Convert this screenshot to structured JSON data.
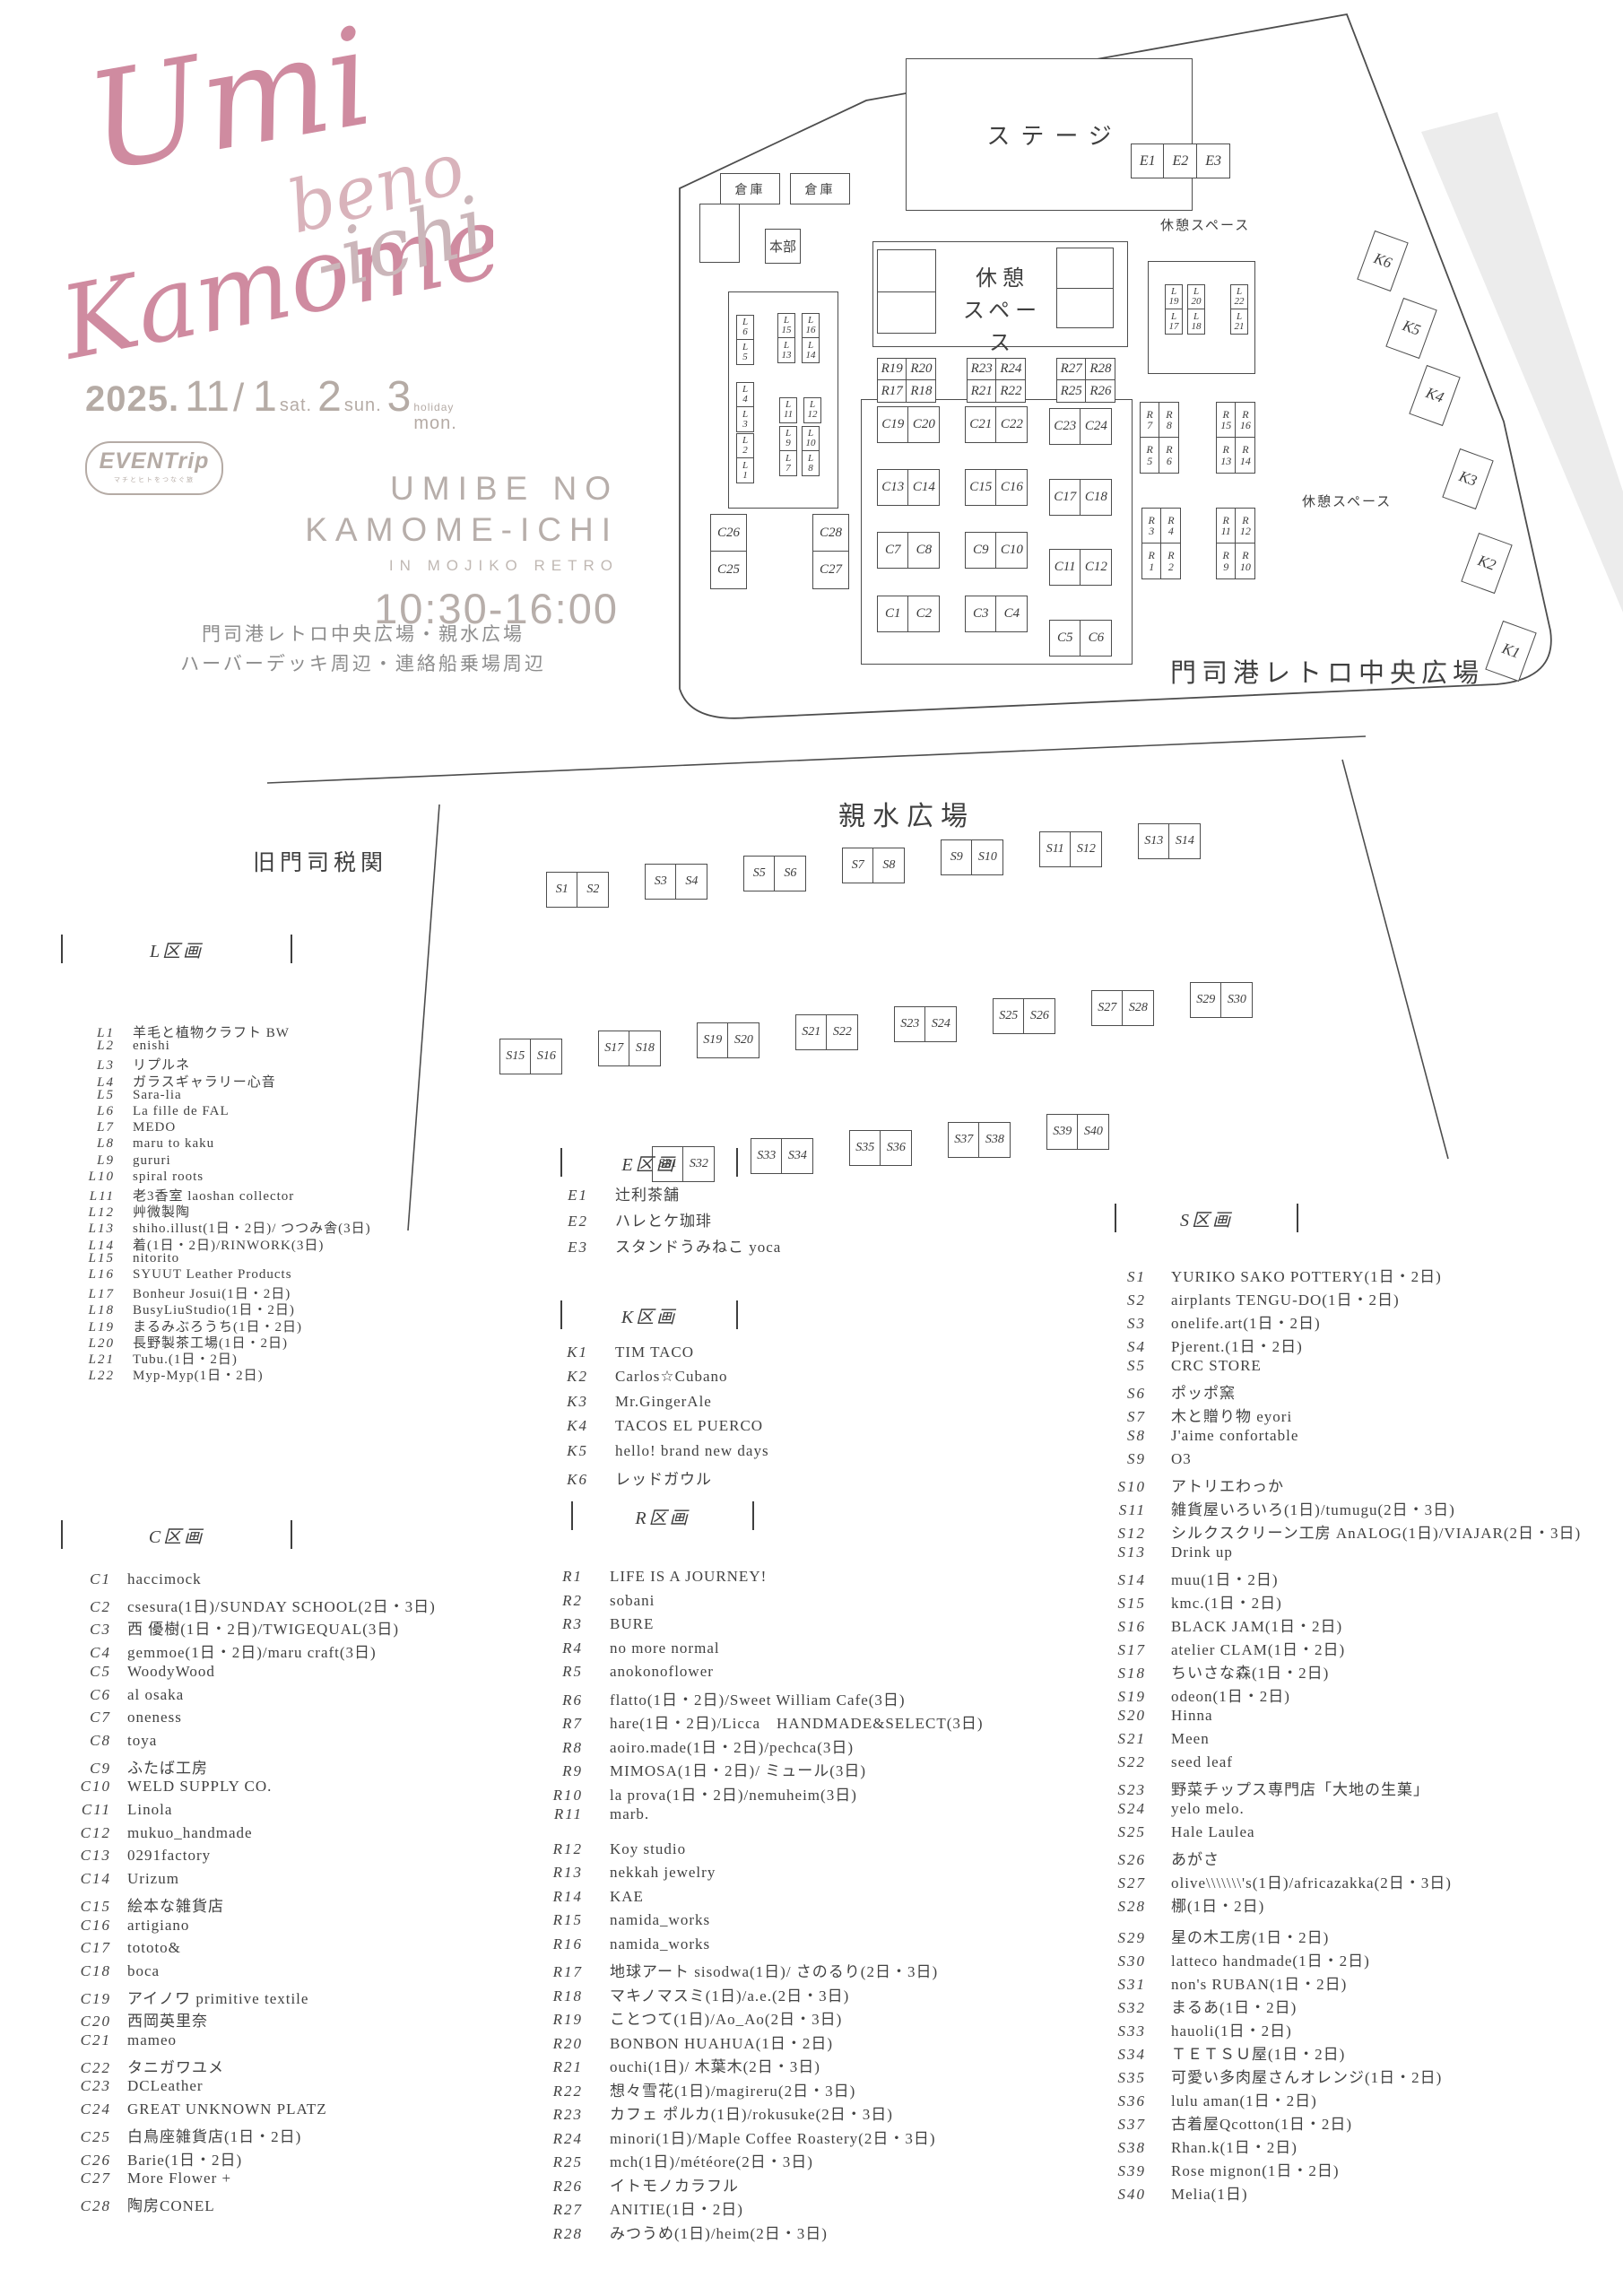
{
  "logo": {
    "word1": "Umi",
    "word2": "beno",
    "word3": "Kamome",
    "word4": "-ichi"
  },
  "event": {
    "year": "2025.",
    "month": "11",
    "slash": "/",
    "day1": "1",
    "day1_suffix": "sat.",
    "day2": "2",
    "day2_suffix": "sun.",
    "day3": "3",
    "day3_suffix": "mon.",
    "day3_note": "holiday",
    "organizer": "EVENTrip",
    "organizer_sub": "マチとヒトをつなぐ旅",
    "title_line1": "UMIBE NO",
    "title_line2": "KAMOME-ICHI",
    "subtitle": "IN MOJIKO RETRO",
    "time": "10:30-16:00",
    "venue_line1": "門司港レトロ中央広場・親水広場",
    "venue_line2": "ハーバーデッキ周辺・連絡船乗場周辺"
  },
  "map_a": {
    "stage": "ステージ",
    "warehouse1": "倉庫",
    "warehouse2": "倉庫",
    "hq": "本部",
    "rest_center": "休憩\nスペース",
    "rest_top_right": "休憩スペース",
    "rest_right": "休憩スペース",
    "area_label": "門司港レトロ中央広場",
    "l_stacks": [
      [
        "L\n6",
        "L\n5"
      ],
      [
        "L\n15",
        "L\n13"
      ],
      [
        "L\n16",
        "L\n14"
      ],
      [
        "L\n4",
        "L\n3"
      ],
      [
        "L\n11"
      ],
      [
        "L\n12"
      ],
      [
        "L\n2",
        "L\n1"
      ],
      [
        "L\n9",
        "L\n7"
      ],
      [
        "L\n10",
        "L\n8"
      ],
      [
        "L\n19",
        "L\n17"
      ],
      [
        "L\n20",
        "L\n18"
      ],
      [
        "L\n22",
        "L\n21"
      ]
    ],
    "c_vstacks": [
      [
        "C26",
        "C25"
      ],
      [
        "C28",
        "C27"
      ]
    ],
    "c_pairs": [
      [
        "C19",
        "C20"
      ],
      [
        "C21",
        "C22"
      ],
      [
        "C23",
        "C24"
      ],
      [
        "C13",
        "C14"
      ],
      [
        "C15",
        "C16"
      ],
      [
        "C17",
        "C18"
      ],
      [
        "C7",
        "C8"
      ],
      [
        "C9",
        "C10"
      ],
      [
        "C11",
        "C12"
      ],
      [
        "C1",
        "C2"
      ],
      [
        "C3",
        "C4"
      ],
      [
        "C5",
        "C6"
      ]
    ],
    "r_blocks": [
      [
        "R19",
        "R20",
        "R17",
        "R18"
      ],
      [
        "R23",
        "R24",
        "R21",
        "R22"
      ],
      [
        "R27",
        "R28",
        "R25",
        "R26"
      ]
    ],
    "r_side_blocks": [
      [
        "R\n7",
        "R\n8",
        "R\n5",
        "R\n6"
      ],
      [
        "R\n15",
        "R\n16",
        "R\n13",
        "R\n14"
      ],
      [
        "R\n3",
        "R\n4",
        "R\n1",
        "R\n2"
      ],
      [
        "R\n11",
        "R\n12",
        "R\n9",
        "R\n10"
      ]
    ],
    "e_row": [
      "E1",
      "E2",
      "E3"
    ],
    "k_boxes": [
      "K6",
      "K5",
      "K4",
      "K3",
      "K2",
      "K1"
    ]
  },
  "map_b": {
    "title": "親水広場",
    "building": "旧門司税関",
    "s_booths": [
      "S1",
      "S2",
      "S3",
      "S4",
      "S5",
      "S6",
      "S7",
      "S8",
      "S9",
      "S10",
      "S11",
      "S12",
      "S13",
      "S14",
      "S15",
      "S16",
      "S17",
      "S18",
      "S19",
      "S20",
      "S21",
      "S22",
      "S23",
      "S24",
      "S25",
      "S26",
      "S27",
      "S28",
      "S29",
      "S30",
      "S31",
      "S32",
      "S33",
      "S34",
      "S35",
      "S36",
      "S37",
      "S38",
      "S39",
      "S40"
    ]
  },
  "lists": {
    "l": {
      "title": "L区画",
      "items": [
        {
          "no": "L1",
          "name": "羊毛と植物クラフト BW"
        },
        {
          "no": "L2",
          "name": "enishi"
        },
        {
          "no": "L3",
          "name": "リプルネ"
        },
        {
          "no": "L4",
          "name": "ガラスギャラリー心音"
        },
        {
          "no": "L5",
          "name": "Sara-lia"
        },
        {
          "no": "L6",
          "name": "La fille de FAL"
        },
        {
          "no": "L7",
          "name": "MEDO"
        },
        {
          "no": "L8",
          "name": "maru to kaku"
        },
        {
          "no": "L9",
          "name": "gururi"
        },
        {
          "no": "L10",
          "name": "spiral roots"
        },
        {
          "no": "L11",
          "name": "老3香室 laoshan collector"
        },
        {
          "no": "L12",
          "name": "艸微製陶"
        },
        {
          "no": "L13",
          "name": "shiho.illust(1日・2日)/ つつみ舎(3日)"
        },
        {
          "no": "L14",
          "name": "着(1日・2日)/RINWORK(3日)"
        },
        {
          "no": "L15",
          "name": "nitorito"
        },
        {
          "no": "L16",
          "name": "SYUUT Leather Products"
        },
        {
          "no": "L17",
          "name": "Bonheur Josui(1日・2日)"
        },
        {
          "no": "L18",
          "name": "BusyLiuStudio(1日・2日)"
        },
        {
          "no": "L19",
          "name": "まるみぶろうち(1日・2日)"
        },
        {
          "no": "L20",
          "name": "長野製茶工場(1日・2日)"
        },
        {
          "no": "L21",
          "name": "Tubu.(1日・2日)"
        },
        {
          "no": "L22",
          "name": "Myp-Myp(1日・2日)"
        }
      ]
    },
    "c": {
      "title": "C区画",
      "items": [
        {
          "no": "C1",
          "name": "haccimock"
        },
        {
          "no": "C2",
          "name": "csesura(1日)/SUNDAY SCHOOL(2日・3日)"
        },
        {
          "no": "C3",
          "name": "西 優樹(1日・2日)/TWIGEQUAL(3日)"
        },
        {
          "no": "C4",
          "name": "gemmoe(1日・2日)/maru craft(3日)"
        },
        {
          "no": "C5",
          "name": "WoodyWood"
        },
        {
          "no": "C6",
          "name": "al osaka"
        },
        {
          "no": "C7",
          "name": "oneness"
        },
        {
          "no": "C8",
          "name": "toya"
        },
        {
          "no": "C9",
          "name": "ふたば工房"
        },
        {
          "no": "C10",
          "name": "WELD SUPPLY CO."
        },
        {
          "no": "C11",
          "name": "Linola"
        },
        {
          "no": "C12",
          "name": "mukuo_handmade"
        },
        {
          "no": "C13",
          "name": "0291factory"
        },
        {
          "no": "C14",
          "name": "Urizum"
        },
        {
          "no": "C15",
          "name": "絵本な雑貨店"
        },
        {
          "no": "C16",
          "name": "artigiano"
        },
        {
          "no": "C17",
          "name": "tototo&"
        },
        {
          "no": "C18",
          "name": "boca"
        },
        {
          "no": "C19",
          "name": "アイノワ primitive textile"
        },
        {
          "no": "C20",
          "name": "西岡英里奈"
        },
        {
          "no": "C21",
          "name": "mameo"
        },
        {
          "no": "C22",
          "name": "タニガワユメ"
        },
        {
          "no": "C23",
          "name": "DCLeather"
        },
        {
          "no": "C24",
          "name": "GREAT UNKNOWN PLATZ"
        },
        {
          "no": "C25",
          "name": "白鳥座雑貨店(1日・2日)"
        },
        {
          "no": "C26",
          "name": "Barie(1日・2日)"
        },
        {
          "no": "C27",
          "name": "More Flower +"
        },
        {
          "no": "C28",
          "name": "陶房CONEL"
        }
      ]
    },
    "e": {
      "title": "E区画",
      "items": [
        {
          "no": "E1",
          "name": "辻利茶舗"
        },
        {
          "no": "E2",
          "name": "ハレとケ珈琲"
        },
        {
          "no": "E3",
          "name": "スタンドうみねこ yoca"
        }
      ]
    },
    "k": {
      "title": "K区画",
      "items": [
        {
          "no": "K1",
          "name": "TIM TACO"
        },
        {
          "no": "K2",
          "name": "Carlos☆Cubano"
        },
        {
          "no": "K3",
          "name": "Mr.GingerAle"
        },
        {
          "no": "K4",
          "name": "TACOS EL PUERCO"
        },
        {
          "no": "K5",
          "name": "hello! brand new days"
        },
        {
          "no": "K6",
          "name": "レッドガウル"
        }
      ]
    },
    "r": {
      "title": "R区画",
      "items": [
        {
          "no": "R1",
          "name": "LIFE IS A JOURNEY!"
        },
        {
          "no": "R2",
          "name": "sobani"
        },
        {
          "no": "R3",
          "name": "BURE"
        },
        {
          "no": "R4",
          "name": "no more normal"
        },
        {
          "no": "R5",
          "name": "anokonoflower"
        },
        {
          "no": "R6",
          "name": "flatto(1日・2日)/Sweet William Cafe(3日)"
        },
        {
          "no": "R7",
          "name": "hare(1日・2日)/Licca　HANDMADE&SELECT(3日)"
        },
        {
          "no": "R8",
          "name": "aoiro.made(1日・2日)/pechca(3日)"
        },
        {
          "no": "R9",
          "name": "MIMOSA(1日・2日)/ ミュール(3日)"
        },
        {
          "no": "R10",
          "name": "la prova(1日・2日)/nemuheim(3日)"
        },
        {
          "no": "R11",
          "name": "marb."
        },
        {
          "no": "R12",
          "name": "Koy studio"
        },
        {
          "no": "R13",
          "name": "nekkah jewelry"
        },
        {
          "no": "R14",
          "name": "KAE"
        },
        {
          "no": "R15",
          "name": "namida_works"
        },
        {
          "no": "R16",
          "name": "namida_works"
        },
        {
          "no": "R17",
          "name": "地球アート sisodwa(1日)/ さのるり(2日・3日)"
        },
        {
          "no": "R18",
          "name": "マキノマスミ(1日)/a.e.(2日・3日)"
        },
        {
          "no": "R19",
          "name": "ことつて(1日)/Ao_Ao(2日・3日)"
        },
        {
          "no": "R20",
          "name": "BONBON HUAHUA(1日・2日)"
        },
        {
          "no": "R21",
          "name": "ouchi(1日)/ 木葉木(2日・3日)"
        },
        {
          "no": "R22",
          "name": "想々雪花(1日)/magireru(2日・3日)"
        },
        {
          "no": "R23",
          "name": "カフェ ポルカ(1日)/rokusuke(2日・3日)"
        },
        {
          "no": "R24",
          "name": "minori(1日)/Maple Coffee Roastery(2日・3日)"
        },
        {
          "no": "R25",
          "name": "mch(1日)/météore(2日・3日)"
        },
        {
          "no": "R26",
          "name": "イトモノカラフル"
        },
        {
          "no": "R27",
          "name": "ANITIE(1日・2日)"
        },
        {
          "no": "R28",
          "name": "みつうめ(1日)/heim(2日・3日)"
        }
      ]
    },
    "s": {
      "title": "S区画",
      "items": [
        {
          "no": "S1",
          "name": "YURIKO SAKO POTTERY(1日・2日)"
        },
        {
          "no": "S2",
          "name": "airplants TENGU-DO(1日・2日)"
        },
        {
          "no": "S3",
          "name": "onelife.art(1日・2日)"
        },
        {
          "no": "S4",
          "name": "Pjerent.(1日・2日)"
        },
        {
          "no": "S5",
          "name": "CRC STORE"
        },
        {
          "no": "S6",
          "name": "ポッポ窯"
        },
        {
          "no": "S7",
          "name": "木と贈り物 eyori"
        },
        {
          "no": "S8",
          "name": "J'aime confortable"
        },
        {
          "no": "S9",
          "name": "O3"
        },
        {
          "no": "S10",
          "name": "アトリエわっか"
        },
        {
          "no": "S11",
          "name": "雑貨屋いろいろ(1日)/tumugu(2日・3日)"
        },
        {
          "no": "S12",
          "name": "シルクスクリーン工房 AnALOG(1日)/VIAJAR(2日・3日)"
        },
        {
          "no": "S13",
          "name": "Drink up"
        },
        {
          "no": "S14",
          "name": "muu(1日・2日)"
        },
        {
          "no": "S15",
          "name": "kmc.(1日・2日)"
        },
        {
          "no": "S16",
          "name": "BLACK JAM(1日・2日)"
        },
        {
          "no": "S17",
          "name": "atelier CLAM(1日・2日)"
        },
        {
          "no": "S18",
          "name": "ちいさな森(1日・2日)"
        },
        {
          "no": "S19",
          "name": "odeon(1日・2日)"
        },
        {
          "no": "S20",
          "name": "Hinna"
        },
        {
          "no": "S21",
          "name": "Meen"
        },
        {
          "no": "S22",
          "name": "seed leaf"
        },
        {
          "no": "S23",
          "name": "野菜チップス専門店「大地の生菓」"
        },
        {
          "no": "S24",
          "name": "yelo melo."
        },
        {
          "no": "S25",
          "name": "Hale Laulea"
        },
        {
          "no": "S26",
          "name": "あがさ"
        },
        {
          "no": "S27",
          "name": "olive\\\\\\\\\\\\\\'s(1日)/africazakka(2日・3日)"
        },
        {
          "no": "S28",
          "name": "梛(1日・2日)"
        },
        {
          "no": "S29",
          "name": "星の木工房(1日・2日)"
        },
        {
          "no": "S30",
          "name": "latteco handmade(1日・2日)"
        },
        {
          "no": "S31",
          "name": "non's RUBAN(1日・2日)"
        },
        {
          "no": "S32",
          "name": "まるあ(1日・2日)"
        },
        {
          "no": "S33",
          "name": "hauoli(1日・2日)"
        },
        {
          "no": "S34",
          "name": "ＴＥＴＳＵ屋(1日・2日)"
        },
        {
          "no": "S35",
          "name": "可愛い多肉屋さんオレンジ(1日・2日)"
        },
        {
          "no": "S36",
          "name": "lulu aman(1日・2日)"
        },
        {
          "no": "S37",
          "name": "古着屋Qcotton(1日・2日)"
        },
        {
          "no": "S38",
          "name": "Rhan.k(1日・2日)"
        },
        {
          "no": "S39",
          "name": "Rose mignon(1日・2日)"
        },
        {
          "no": "S40",
          "name": "Melia(1日)"
        }
      ]
    }
  },
  "colors": {
    "accent_pink": "#cf8ba0",
    "accent_pink_light": "#d9b3bb",
    "muted_taupe": "#b5aba5",
    "line": "#4d4d4d"
  }
}
